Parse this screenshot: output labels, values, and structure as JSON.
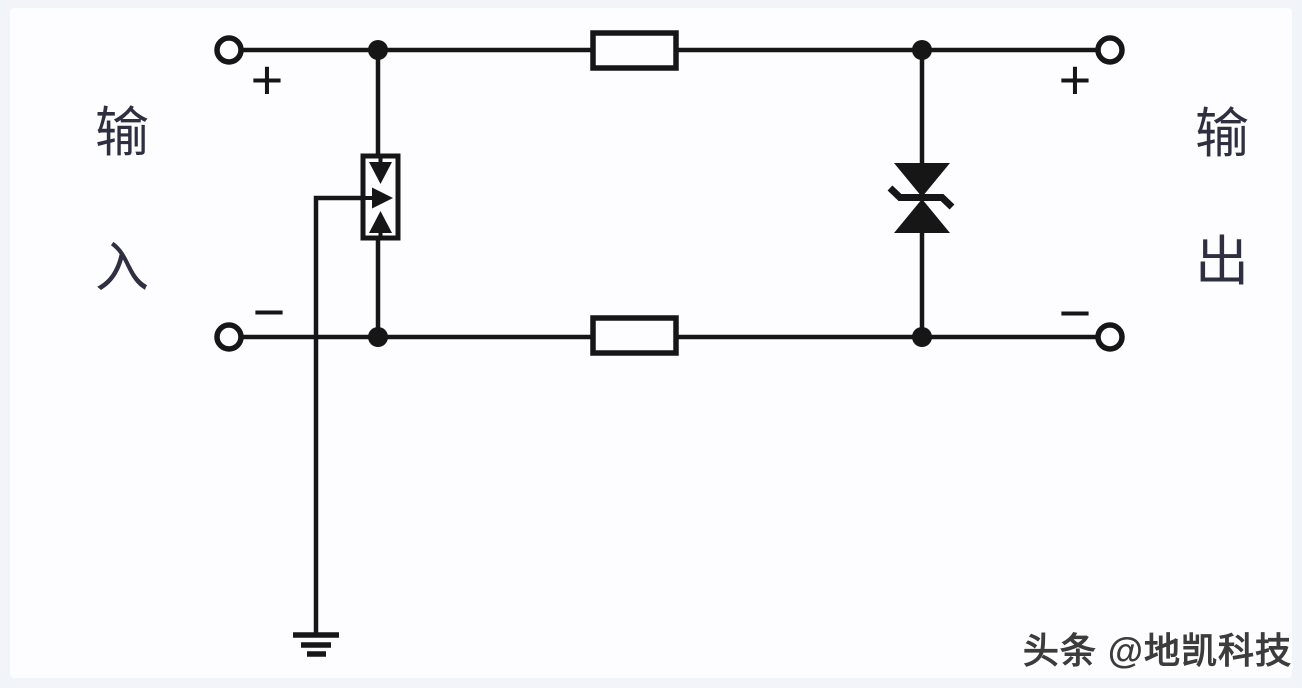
{
  "diagram": {
    "left_label": {
      "word": "输入",
      "chars": [
        "输",
        "入"
      ]
    },
    "right_label": {
      "word": "输出",
      "chars": [
        "输",
        "出"
      ]
    },
    "polarity": {
      "plus": "+",
      "minus": "−"
    },
    "symbols": [
      "input-positive-terminal",
      "input-negative-terminal",
      "output-positive-terminal",
      "output-negative-terminal",
      "series-resistor-top",
      "series-resistor-bottom",
      "three-electrode-gas-discharge-tube",
      "bidirectional-tvs-diode",
      "earth-ground"
    ],
    "watermark": "头条 @地凯科技",
    "colors": {
      "stroke": "#161616",
      "label_text": "#2f2f42",
      "watermark_text": "#3c3c3c",
      "canvas": "#fdfdff",
      "frame": "#f1f4f9"
    }
  }
}
